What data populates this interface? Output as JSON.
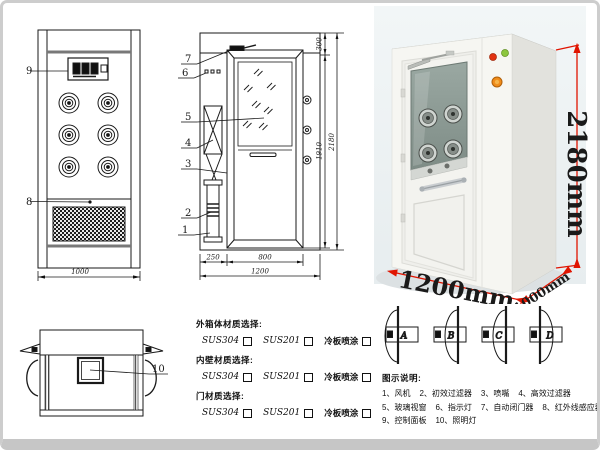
{
  "drawings": {
    "front_view": {
      "callout_control_panel": "9",
      "callout_grille": "8",
      "dim_width": "1000"
    },
    "side_view": {
      "callouts": [
        "7",
        "6",
        "5",
        "4",
        "3",
        "2",
        "1"
      ],
      "dim_top_section": "300",
      "dim_door_height": "1910",
      "dim_total_height": "2180",
      "dim_side_panel": "250",
      "dim_door_width": "800",
      "dim_total_width": "1200"
    },
    "top_view": {
      "callout_lamp": "10"
    },
    "door_swing_options": [
      "A",
      "B",
      "C",
      "D"
    ]
  },
  "photo": {
    "dim_height": "2180mm",
    "dim_width": "1200mm",
    "dim_depth": "1000mm",
    "dim_text_color": "#d21000",
    "cabinet_color": "#f6f6f2",
    "glass_color": "#90a09a"
  },
  "materials": {
    "sections": [
      {
        "title": "外箱体材质选择:",
        "options": [
          "SUS304",
          "SUS201",
          "冷板喷涂"
        ]
      },
      {
        "title": "内壁材质选择:",
        "options": [
          "SUS304",
          "SUS201",
          "冷板喷涂"
        ]
      },
      {
        "title": "门材质选择:",
        "options": [
          "SUS304",
          "SUS201",
          "冷板喷涂"
        ]
      }
    ]
  },
  "legend": {
    "title": "图示说明:",
    "rows": [
      [
        "1、风机",
        "2、初效过滤器",
        "3、喷嘴",
        "4、高效过滤器"
      ],
      [
        "5、玻璃视窗",
        "6、指示灯",
        "7、自动闭门器",
        "8、红外线感应器"
      ],
      [
        "9、控制面板",
        "10、照明灯"
      ]
    ]
  }
}
